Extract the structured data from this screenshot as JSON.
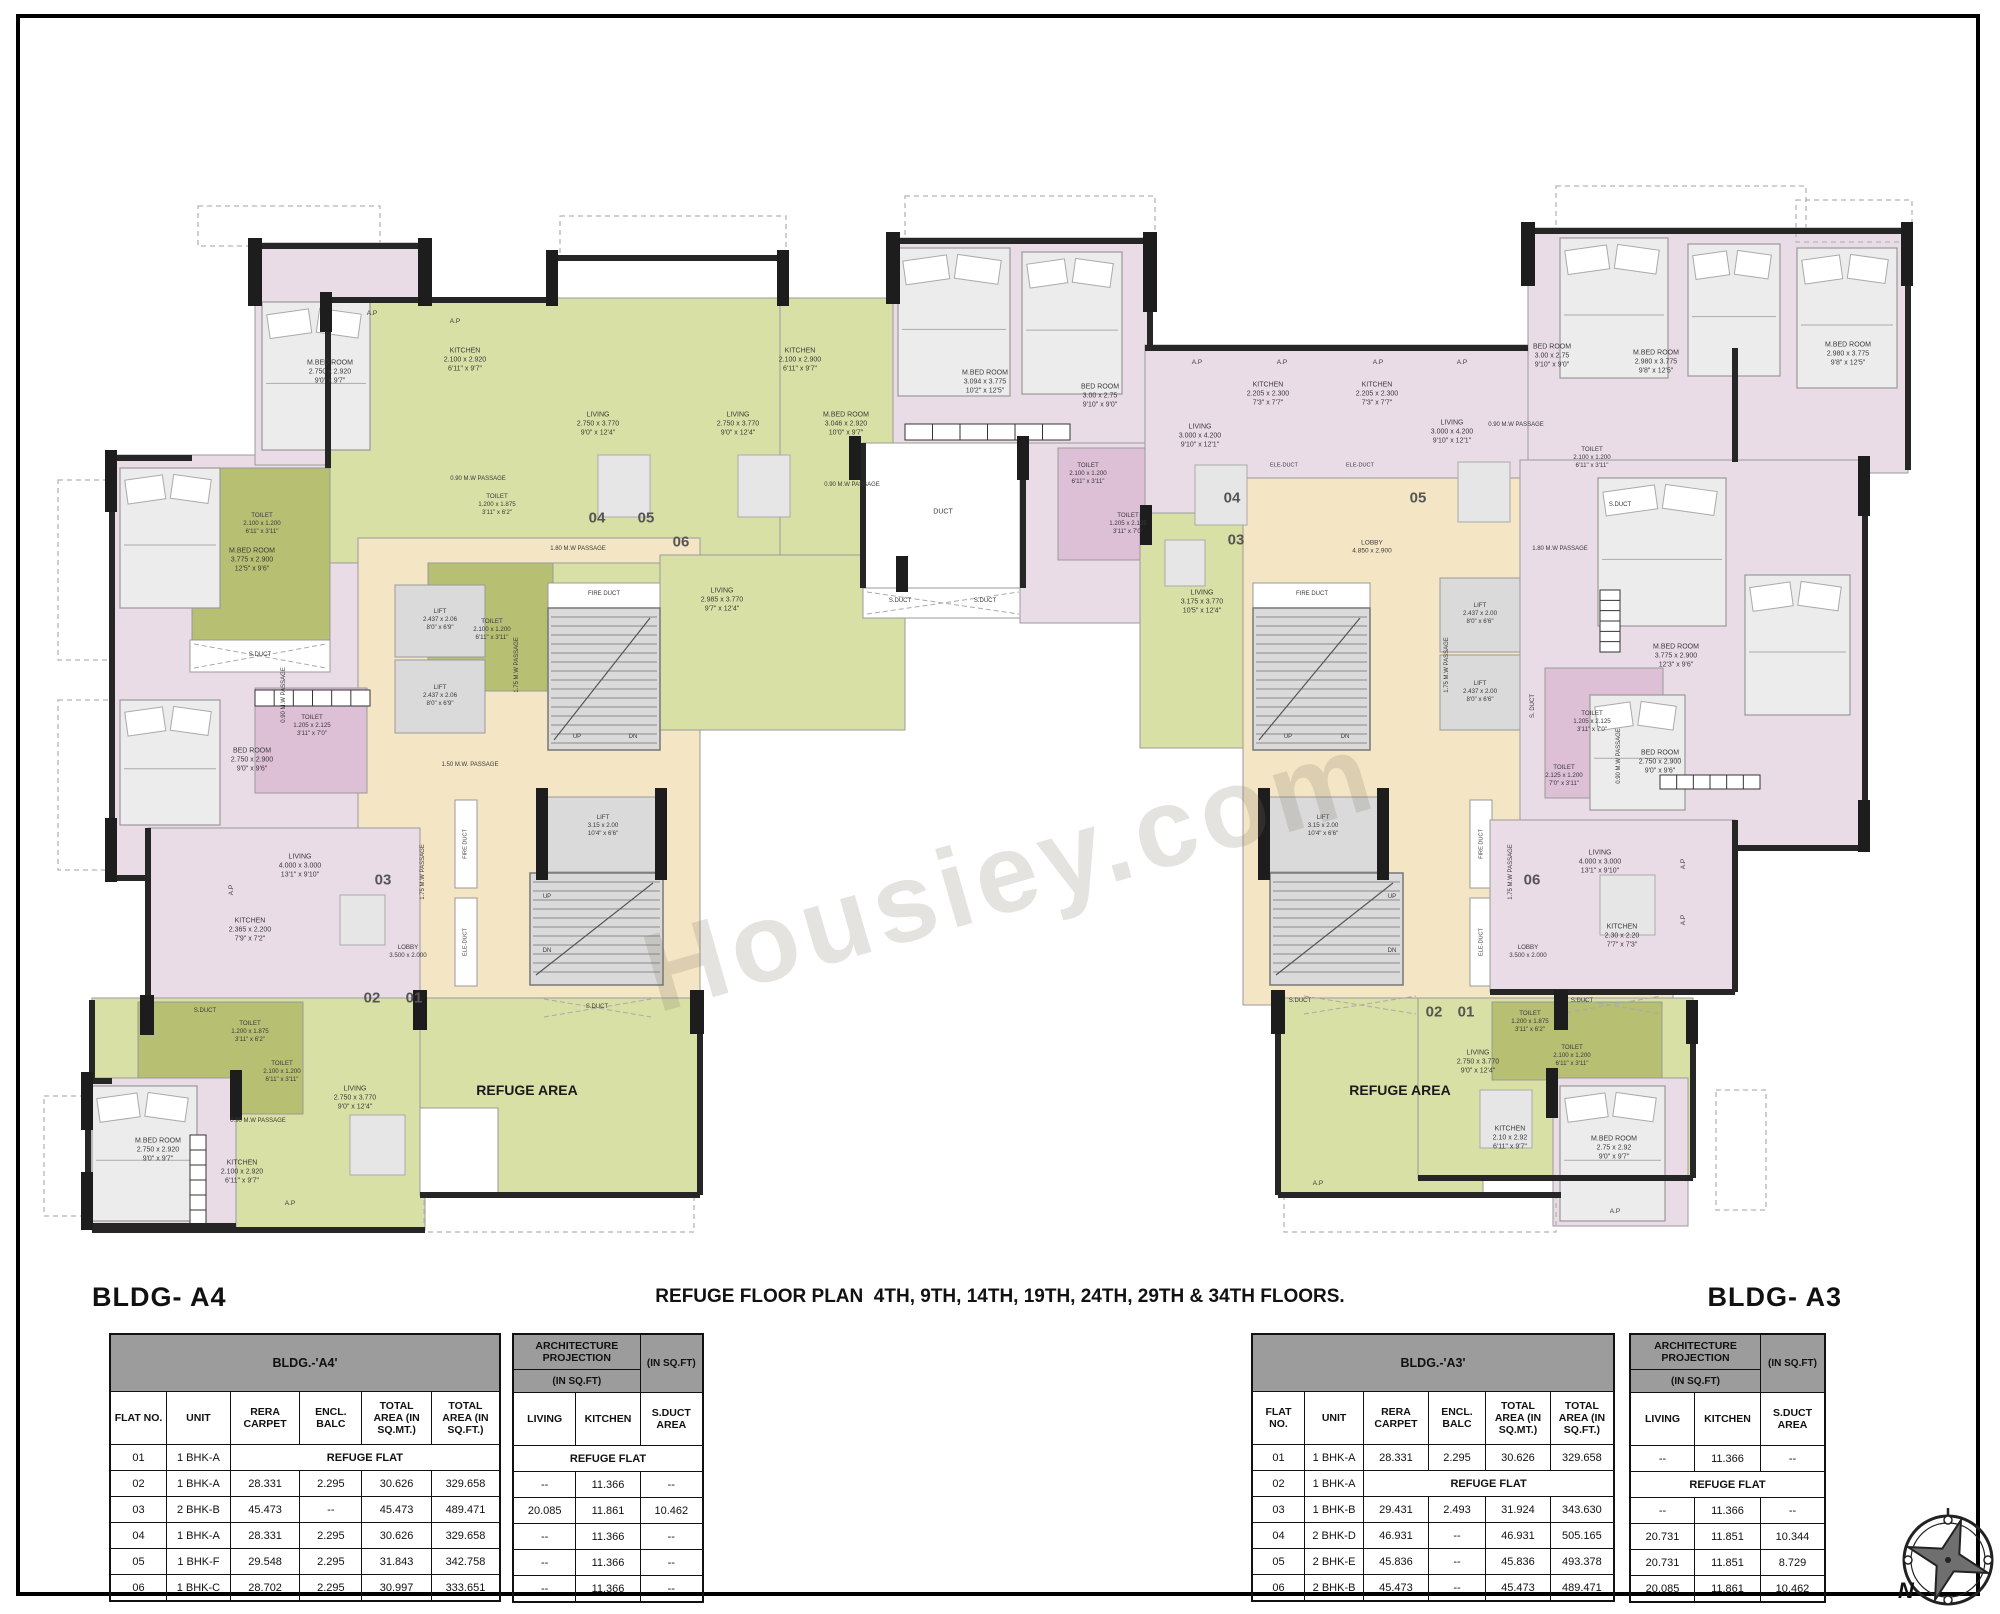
{
  "watermark": "Housiey.com",
  "header": {
    "title": "REFUGE FLOOR PLAN  4TH, 9TH, 14TH, 19TH, 24TH, 29TH & 34TH FLOORS.",
    "bldg_left": "BLDG- A4",
    "bldg_right": "BLDG- A3"
  },
  "compass": {
    "label": "N"
  },
  "tables": {
    "a4": {
      "band": "BLDG.-'A4'",
      "columns": [
        "FLAT NO.",
        "UNIT",
        "RERA CARPET",
        "ENCL. BALC",
        "TOTAL AREA (IN SQ.MT.)",
        "TOTAL AREA (IN SQ.FT.)"
      ],
      "refuge_text": "REFUGE FLAT",
      "rows": [
        [
          "01",
          "1 BHK-A",
          "REFUGE FLAT",
          "",
          "",
          ""
        ],
        [
          "02",
          "1 BHK-A",
          "28.331",
          "2.295",
          "30.626",
          "329.658"
        ],
        [
          "03",
          "2 BHK-B",
          "45.473",
          "--",
          "45.473",
          "489.471"
        ],
        [
          "04",
          "1 BHK-A",
          "28.331",
          "2.295",
          "30.626",
          "329.658"
        ],
        [
          "05",
          "1 BHK-F",
          "29.548",
          "2.295",
          "31.843",
          "342.758"
        ],
        [
          "06",
          "1 BHK-C",
          "28.702",
          "2.295",
          "30.997",
          "333.651"
        ]
      ],
      "arch": {
        "band_top": "ARCHITECTURE PROJECTION",
        "band_sub": "(IN SQ.FT)",
        "band_right": "(IN SQ.FT)",
        "columns": [
          "LIVING",
          "KITCHEN",
          "S.DUCT AREA"
        ],
        "rows": [
          [
            "REFUGE FLAT"
          ],
          [
            "--",
            "11.366",
            "--"
          ],
          [
            "20.085",
            "11.861",
            "10.462"
          ],
          [
            "--",
            "11.366",
            "--"
          ],
          [
            "--",
            "11.366",
            "--"
          ],
          [
            "--",
            "11.366",
            "--"
          ]
        ]
      }
    },
    "a3": {
      "band": "BLDG.-'A3'",
      "columns": [
        "FLAT NO.",
        "UNIT",
        "RERA CARPET",
        "ENCL. BALC",
        "TOTAL AREA (IN SQ.MT.)",
        "TOTAL AREA (IN SQ.FT.)"
      ],
      "refuge_text": "REFUGE FLAT",
      "rows": [
        [
          "01",
          "1 BHK-A",
          "28.331",
          "2.295",
          "30.626",
          "329.658"
        ],
        [
          "02",
          "1 BHK-A",
          "REFUGE FLAT",
          "",
          "",
          ""
        ],
        [
          "03",
          "1 BHK-B",
          "29.431",
          "2.493",
          "31.924",
          "343.630"
        ],
        [
          "04",
          "2 BHK-D",
          "46.931",
          "--",
          "46.931",
          "505.165"
        ],
        [
          "05",
          "2 BHK-E",
          "45.836",
          "--",
          "45.836",
          "493.378"
        ],
        [
          "06",
          "2 BHK-B",
          "45.473",
          "--",
          "45.473",
          "489.471"
        ]
      ],
      "arch": {
        "band_top": "ARCHITECTURE PROJECTION",
        "band_sub": "(IN SQ.FT)",
        "band_right": "(IN SQ.FT)",
        "columns": [
          "LIVING",
          "KITCHEN",
          "S.DUCT AREA"
        ],
        "rows": [
          [
            "--",
            "11.366",
            "--"
          ],
          [
            "REFUGE FLAT"
          ],
          [
            "--",
            "11.366",
            "--"
          ],
          [
            "20.731",
            "11.851",
            "10.344"
          ],
          [
            "20.731",
            "11.851",
            "8.729"
          ],
          [
            "20.085",
            "11.861",
            "10.462"
          ]
        ]
      }
    }
  },
  "plan": {
    "labels": [
      {
        "t": "M.BED ROOM\n2.750 x 2.920\n9'0\" x 9'7\"",
        "x": 330,
        "y": 372
      },
      {
        "t": "KITCHEN\n2.100 x 2.920\n6'11\" x 9'7\"",
        "x": 465,
        "y": 360
      },
      {
        "t": "A.P",
        "x": 372,
        "y": 314,
        "s": 6.5
      },
      {
        "t": "A.P",
        "x": 455,
        "y": 322,
        "s": 6.5
      },
      {
        "t": "LIVING\n2.750 x 3.770\n9'0\" x 12'4\"",
        "x": 598,
        "y": 424
      },
      {
        "t": "LIVING\n2.750 x 3.770\n9'0\" x 12'4\"",
        "x": 738,
        "y": 424
      },
      {
        "t": "0.90 M.W PASSAGE",
        "x": 478,
        "y": 480,
        "s": 6
      },
      {
        "t": "TOILET\n2.100 x 1.200\n6'11\" x 3'11\"",
        "x": 262,
        "y": 524,
        "s": 6.2
      },
      {
        "t": "TOILET\n1.200 x 1.875\n3'11\" x 6'2\"",
        "x": 497,
        "y": 505,
        "s": 6.2
      },
      {
        "t": "TOILET\n2.100 x 1.200\n6'11\" x 3'11\"",
        "x": 492,
        "y": 630,
        "s": 6.2
      },
      {
        "t": "S.DUCT",
        "x": 260,
        "y": 656,
        "s": 6
      },
      {
        "t": "M.BED ROOM\n3.775 x 2.900\n12'5\" x 9'6\"",
        "x": 252,
        "y": 560
      },
      {
        "t": "BED ROOM\n2.750 x 2.900\n9'0\" x 9'6\"",
        "x": 252,
        "y": 760
      },
      {
        "t": "TOILET\n1.205 x 2.125\n3'11\" x 7'0\"",
        "x": 312,
        "y": 726,
        "s": 6.2
      },
      {
        "t": "0.90 M.W PASSAGE",
        "x": 285,
        "y": 695,
        "s": 6,
        "r": -90
      },
      {
        "t": "04",
        "x": 597,
        "y": 518,
        "s": 15,
        "w": 700,
        "c": "#555"
      },
      {
        "t": "05",
        "x": 646,
        "y": 518,
        "s": 15,
        "w": 700,
        "c": "#555"
      },
      {
        "t": "06",
        "x": 681,
        "y": 542,
        "s": 15,
        "w": 700,
        "c": "#555"
      },
      {
        "t": "LIFT\n2.437 x 2.06\n8'0\" x 6'9\"",
        "x": 440,
        "y": 620,
        "s": 6.2
      },
      {
        "t": "LIFT\n2.437 x 2.06\n8'0\" x 6'9\"",
        "x": 440,
        "y": 696,
        "s": 6.2
      },
      {
        "t": "FIRE DUCT",
        "x": 604,
        "y": 595,
        "s": 6
      },
      {
        "t": "UP",
        "x": 577,
        "y": 738,
        "s": 6
      },
      {
        "t": "DN",
        "x": 633,
        "y": 738,
        "s": 6
      },
      {
        "t": "1.80 M.W PASSAGE",
        "x": 578,
        "y": 550,
        "s": 6
      },
      {
        "t": "1.75 M.W PASSAGE",
        "x": 518,
        "y": 665,
        "s": 6,
        "r": -90
      },
      {
        "t": "1.50 M.W. PASSAGE",
        "x": 470,
        "y": 766,
        "s": 6
      },
      {
        "t": "1.75 M.W PASSAGE",
        "x": 424,
        "y": 872,
        "s": 6,
        "r": -90
      },
      {
        "t": "LIFT\n3.15 x 2.00\n10'4\" x 6'6\"",
        "x": 603,
        "y": 826,
        "s": 6.2
      },
      {
        "t": "UP",
        "x": 547,
        "y": 898,
        "s": 6
      },
      {
        "t": "DN",
        "x": 547,
        "y": 952,
        "s": 6
      },
      {
        "t": "FIRE DUCT",
        "x": 466,
        "y": 844,
        "s": 5.6,
        "r": -90
      },
      {
        "t": "ELE-DUCT",
        "x": 466,
        "y": 942,
        "s": 5.6,
        "r": -90
      },
      {
        "t": "LOBBY\n3.500 x 2.000",
        "x": 408,
        "y": 952,
        "s": 6.2
      },
      {
        "t": "03",
        "x": 383,
        "y": 880,
        "s": 15,
        "w": 700,
        "c": "#555"
      },
      {
        "t": "LIVING\n4.000 x 3.000\n13'1\" x 9'10\"",
        "x": 300,
        "y": 866
      },
      {
        "t": "KITCHEN\n2.365 x 2.200\n7'9\" x 7'2\"",
        "x": 250,
        "y": 930
      },
      {
        "t": "A.P",
        "x": 232,
        "y": 890,
        "s": 6.5,
        "r": -90
      },
      {
        "t": "02",
        "x": 372,
        "y": 998,
        "s": 15,
        "w": 700,
        "c": "#555"
      },
      {
        "t": "01",
        "x": 414,
        "y": 998,
        "s": 15,
        "w": 700,
        "c": "#555"
      },
      {
        "t": "S.DUCT",
        "x": 205,
        "y": 1012,
        "s": 6
      },
      {
        "t": "TOILET\n1.200 x 1.875\n3'11\" x 6'2\"",
        "x": 250,
        "y": 1032,
        "s": 6.2
      },
      {
        "t": "TOILET\n2.100 x 1.200\n6'11\" x 3'11\"",
        "x": 282,
        "y": 1072,
        "s": 6.2
      },
      {
        "t": "LIVING\n2.750 x 3.770\n9'0\" x 12'4\"",
        "x": 355,
        "y": 1098
      },
      {
        "t": "0.90 M.W PASSAGE",
        "x": 258,
        "y": 1122,
        "s": 6
      },
      {
        "t": "KITCHEN\n2.100 x 2.920\n6'11\" x 9'7\"",
        "x": 242,
        "y": 1172
      },
      {
        "t": "M.BED ROOM\n2.750 x 2.920\n9'0\" x 9'7\"",
        "x": 158,
        "y": 1150
      },
      {
        "t": "A.P",
        "x": 290,
        "y": 1204,
        "s": 6.5
      },
      {
        "t": "REFUGE AREA",
        "x": 527,
        "y": 1090,
        "s": 14,
        "w": 700,
        "c": "#1a1a1a"
      },
      {
        "t": "S.DUCT",
        "x": 597,
        "y": 1008,
        "s": 6
      },
      {
        "t": "LIVING\n2.985 x 3.770\n9'7\" x 12'4\"",
        "x": 722,
        "y": 600
      },
      {
        "t": "KITCHEN\n2.100 x 2.900\n6'11\" x 9'7\"",
        "x": 800,
        "y": 360
      },
      {
        "t": "M.BED ROOM\n3.046 x 2.920\n10'0\" x 9'7\"",
        "x": 846,
        "y": 424
      },
      {
        "t": "0.90 M.W PASSAGE",
        "x": 852,
        "y": 486,
        "s": 6
      },
      {
        "t": "M.BED ROOM\n3.094 x 3.775\n10'2\" x 12'5\"",
        "x": 985,
        "y": 382
      },
      {
        "t": "BED ROOM\n3.00 x 2.75\n9'10\" x 9'0\"",
        "x": 1100,
        "y": 396
      },
      {
        "t": "DUCT",
        "x": 943,
        "y": 512,
        "s": 7
      },
      {
        "t": "S.DUCT",
        "x": 900,
        "y": 602,
        "s": 6
      },
      {
        "t": "S.DUCT",
        "x": 985,
        "y": 602,
        "s": 6
      },
      {
        "t": "TOILET\n2.100 x 1.200\n6'11\" x 3'11\"",
        "x": 1088,
        "y": 474,
        "s": 6.2
      },
      {
        "t": "TOILET\n1.205 x 2.125\n3'11\" x 7'0\"",
        "x": 1128,
        "y": 524,
        "s": 6.2
      },
      {
        "t": "A.P",
        "x": 1197,
        "y": 363,
        "s": 6.5
      },
      {
        "t": "A.P",
        "x": 1282,
        "y": 363,
        "s": 6.5
      },
      {
        "t": "A.P",
        "x": 1378,
        "y": 363,
        "s": 6.5
      },
      {
        "t": "A.P",
        "x": 1462,
        "y": 363,
        "s": 6.5
      },
      {
        "t": "KITCHEN\n2.205 x 2.300\n7'3\" x 7'7\"",
        "x": 1268,
        "y": 394
      },
      {
        "t": "KITCHEN\n2.205 x 2.300\n7'3\" x 7'7\"",
        "x": 1377,
        "y": 394
      },
      {
        "t": "LIVING\n3.000 x 4.200\n9'10\" x 12'1\"",
        "x": 1200,
        "y": 436
      },
      {
        "t": "LIVING\n3.000 x 4.200\n9'10\" x 12'1\"",
        "x": 1452,
        "y": 432
      },
      {
        "t": "ELE-DUCT",
        "x": 1284,
        "y": 466,
        "s": 5.6
      },
      {
        "t": "ELE-DUCT",
        "x": 1360,
        "y": 466,
        "s": 5.6
      },
      {
        "t": "LOBBY\n4.850 x 2.900",
        "x": 1372,
        "y": 548,
        "s": 6.5
      },
      {
        "t": "04",
        "x": 1232,
        "y": 498,
        "s": 15,
        "w": 700,
        "c": "#555"
      },
      {
        "t": "05",
        "x": 1418,
        "y": 498,
        "s": 15,
        "w": 700,
        "c": "#555"
      },
      {
        "t": "03",
        "x": 1236,
        "y": 540,
        "s": 15,
        "w": 700,
        "c": "#555"
      },
      {
        "t": "LIVING\n3.175 x 3.770\n10'5\" x 12'4\"",
        "x": 1202,
        "y": 602
      },
      {
        "t": "0.90 M.W PASSAGE",
        "x": 1516,
        "y": 426,
        "s": 6
      },
      {
        "t": "FIRE DUCT",
        "x": 1312,
        "y": 595,
        "s": 6
      },
      {
        "t": "UP",
        "x": 1288,
        "y": 738,
        "s": 6
      },
      {
        "t": "DN",
        "x": 1345,
        "y": 738,
        "s": 6
      },
      {
        "t": "LIFT\n2.437 x 2.00\n8'0\" x 6'6\"",
        "x": 1480,
        "y": 614,
        "s": 6.2
      },
      {
        "t": "LIFT\n2.437 x 2.00\n8'0\" x 6'6\"",
        "x": 1480,
        "y": 692,
        "s": 6.2
      },
      {
        "t": "1.80 M.W PASSAGE",
        "x": 1560,
        "y": 550,
        "s": 6
      },
      {
        "t": "1.75 M.W PASSAGE",
        "x": 1448,
        "y": 665,
        "s": 6,
        "r": -90
      },
      {
        "t": "LIFT\n3.15 x 2.00\n10'4\" x 6'6\"",
        "x": 1323,
        "y": 826,
        "s": 6.2
      },
      {
        "t": "UP",
        "x": 1392,
        "y": 898,
        "s": 6
      },
      {
        "t": "DN",
        "x": 1392,
        "y": 952,
        "s": 6
      },
      {
        "t": "FIRE DUCT",
        "x": 1482,
        "y": 844,
        "s": 5.6,
        "r": -90
      },
      {
        "t": "ELE-DUCT",
        "x": 1482,
        "y": 942,
        "s": 5.6,
        "r": -90
      },
      {
        "t": "LOBBY\n3.500 x 2.000",
        "x": 1528,
        "y": 952,
        "s": 6.2
      },
      {
        "t": "1.75 M.W PASSAGE",
        "x": 1512,
        "y": 872,
        "s": 6,
        "r": -90
      },
      {
        "t": "S. DUCT",
        "x": 1534,
        "y": 706,
        "s": 6,
        "r": -90
      },
      {
        "t": "TOILET\n1.205 x 2.125\n3'11\" x 7'0\"",
        "x": 1592,
        "y": 722,
        "s": 6.2
      },
      {
        "t": "TOILET\n2.125 x 1.200\n7'0\" x 3'11\"",
        "x": 1564,
        "y": 776,
        "s": 6.2
      },
      {
        "t": "M.BED ROOM\n3.775 x 2.900\n12'3\" x 9'6\"",
        "x": 1676,
        "y": 656
      },
      {
        "t": "BED ROOM\n2.750 x 2.900\n9'0\" x 9'6\"",
        "x": 1660,
        "y": 762
      },
      {
        "t": "06",
        "x": 1532,
        "y": 880,
        "s": 15,
        "w": 700,
        "c": "#555"
      },
      {
        "t": "LIVING\n4.000 x 3.000\n13'1\" x 9'10\"",
        "x": 1600,
        "y": 862
      },
      {
        "t": "KITCHEN\n2.30 x 2.20\n7'7\" x 7'3\"",
        "x": 1622,
        "y": 936
      },
      {
        "t": "A.P",
        "x": 1684,
        "y": 864,
        "s": 6.5,
        "r": -90
      },
      {
        "t": "A.P",
        "x": 1684,
        "y": 920,
        "s": 6.5,
        "r": -90
      },
      {
        "t": "0.90 M.W PASSAGE",
        "x": 1620,
        "y": 756,
        "s": 6,
        "r": -90
      },
      {
        "t": "BED ROOM\n3.00 x 2.75\n9'10\" x 9'0\"",
        "x": 1552,
        "y": 356
      },
      {
        "t": "M.BED ROOM\n2.980 x 3.775\n9'8\" x 12'5\"",
        "x": 1656,
        "y": 362
      },
      {
        "t": "TOILET\n2.100 x 1.200\n6'11\" x 3'11\"",
        "x": 1592,
        "y": 458,
        "s": 6.2
      },
      {
        "t": "S.DUCT",
        "x": 1620,
        "y": 506,
        "s": 6
      },
      {
        "t": "M.BED ROOM\n2.980 x 3.775\n9'8\" x 12'5\"",
        "x": 1848,
        "y": 354
      },
      {
        "t": "S.DUCT",
        "x": 1300,
        "y": 1002,
        "s": 6
      },
      {
        "t": "S.DUCT",
        "x": 1582,
        "y": 1002,
        "s": 6
      },
      {
        "t": "REFUGE AREA",
        "x": 1400,
        "y": 1090,
        "s": 14,
        "w": 700,
        "c": "#1a1a1a"
      },
      {
        "t": "02",
        "x": 1434,
        "y": 1012,
        "s": 15,
        "w": 700,
        "c": "#555"
      },
      {
        "t": "01",
        "x": 1466,
        "y": 1012,
        "s": 15,
        "w": 700,
        "c": "#555"
      },
      {
        "t": "LIVING\n2.750 x 3.770\n9'0\" x 12'4\"",
        "x": 1478,
        "y": 1062
      },
      {
        "t": "TOILET\n1.200 x 1.875\n3'11\" x 6'2\"",
        "x": 1530,
        "y": 1022,
        "s": 6.2
      },
      {
        "t": "TOILET\n2.100 x 1.200\n6'11\" x 3'11\"",
        "x": 1572,
        "y": 1056,
        "s": 6.2
      },
      {
        "t": "KITCHEN\n2.10 x 2.92\n6'11\" x 9'7\"",
        "x": 1510,
        "y": 1138
      },
      {
        "t": "M.BED ROOM\n2.75 x 2.92\n9'0\" x 9'7\"",
        "x": 1614,
        "y": 1148
      },
      {
        "t": "A.P",
        "x": 1318,
        "y": 1184,
        "s": 6.5
      },
      {
        "t": "A.P",
        "x": 1615,
        "y": 1212,
        "s": 6.5
      }
    ]
  }
}
